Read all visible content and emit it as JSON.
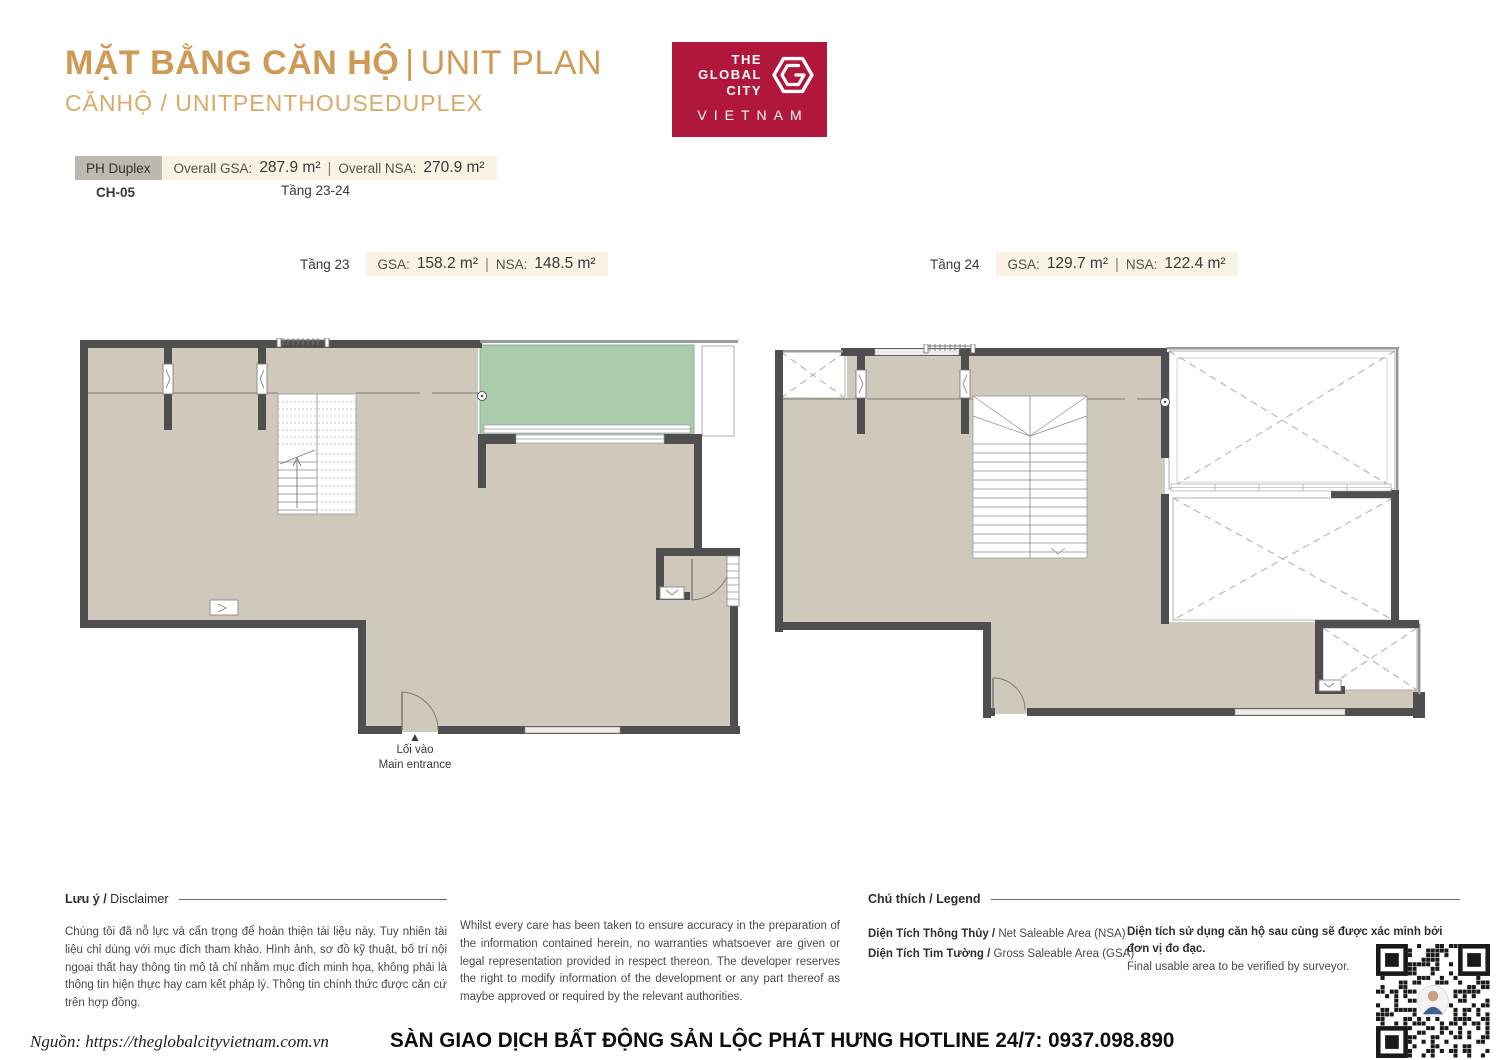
{
  "header": {
    "title_vn": "MẶT BẰNG CĂN HỘ",
    "title_divider": "|",
    "title_en": "UNIT PLAN",
    "subtitle": "CĂNHỘ / UNITPENTHOUSEDUPLEX"
  },
  "logo": {
    "line1": "THE",
    "line2": "GLOBAL",
    "line3": "CITY",
    "country": "VIETNAM"
  },
  "unit_summary": {
    "type_badge": "PH Duplex",
    "overall_gsa_label": "Overall GSA:",
    "overall_gsa_value": "287.9 m²",
    "divider": "|",
    "overall_nsa_label": "Overall NSA:",
    "overall_nsa_value": "270.9 m²",
    "unit_code": "CH-05",
    "floors_range": "Tầng 23-24"
  },
  "floor_sections": [
    {
      "name": "Tầng 23",
      "gsa_label": "GSA:",
      "gsa_value": "158.2 m²",
      "divider": "|",
      "nsa_label": "NSA:",
      "nsa_value": "148.5 m²"
    },
    {
      "name": "Tầng 24",
      "gsa_label": "GSA:",
      "gsa_value": "129.7 m²",
      "divider": "|",
      "nsa_label": "NSA:",
      "nsa_value": "122.4 m²"
    }
  ],
  "plan": {
    "entrance_vn": "Lối vào",
    "entrance_en": "Main entrance"
  },
  "disclaimer": {
    "heading_vn": "Lưu ý / ",
    "heading_en": "Disclaimer",
    "text_vn": "Chúng tôi đã nỗ lực và cẩn trọng để hoàn thiện tài liệu này. Tuy nhiên tài liệu chỉ dùng với mục đích tham khảo. Hình ảnh, sơ đồ kỹ thuật, bố trí nội ngoại thất hay thông tin mô tả chỉ nhằm mục đích minh họa, không phải là thông tin hiện thực hay cam kết pháp lý. Thông tin chính thức được căn cứ trên hợp đồng.",
    "text_en": "Whilst every care has been taken to ensure accuracy in the preparation of the information contained herein, no warranties whatsoever are given or legal representation provided in respect thereon. The developer reserves the right to modify information of the development or any part thereof as maybe approved or required by the relevant authorities."
  },
  "legend": {
    "heading_vn": "Chú thích / ",
    "heading_en": "Legend",
    "items": [
      {
        "vn": "Diện Tích Thông Thủy / ",
        "en": "Net Saleable Area (NSA)"
      },
      {
        "vn": "Diện Tích Tim Tường / ",
        "en": "Gross Saleable Area (GSA)"
      }
    ],
    "note_vn": "Diện tích sử dụng căn hộ sau cùng sẽ được xác minh bởi đơn vị đo đạc.",
    "note_en": "Final usable area to be verified by surveyor."
  },
  "bottom_bar": {
    "source": "Nguồn: https://theglobalcityvietnam.com.vn",
    "hotline": "SÀN GIAO DỊCH BẤT ĐỘNG SẢN LỘC PHÁT HƯNG HOTLINE 24/7: 0937.098.890"
  },
  "colors": {
    "accent_gold": "#CE9A55",
    "subtitle_gold": "#D8AA67",
    "logo_red": "#B0173B",
    "floor_beige": "#CFC9BC",
    "wall_dark": "#4F4F4F",
    "balcony_green": "#ABCBAD",
    "chip_cream": "#FAF2E3",
    "chip_gray": "#BDB8B0"
  }
}
